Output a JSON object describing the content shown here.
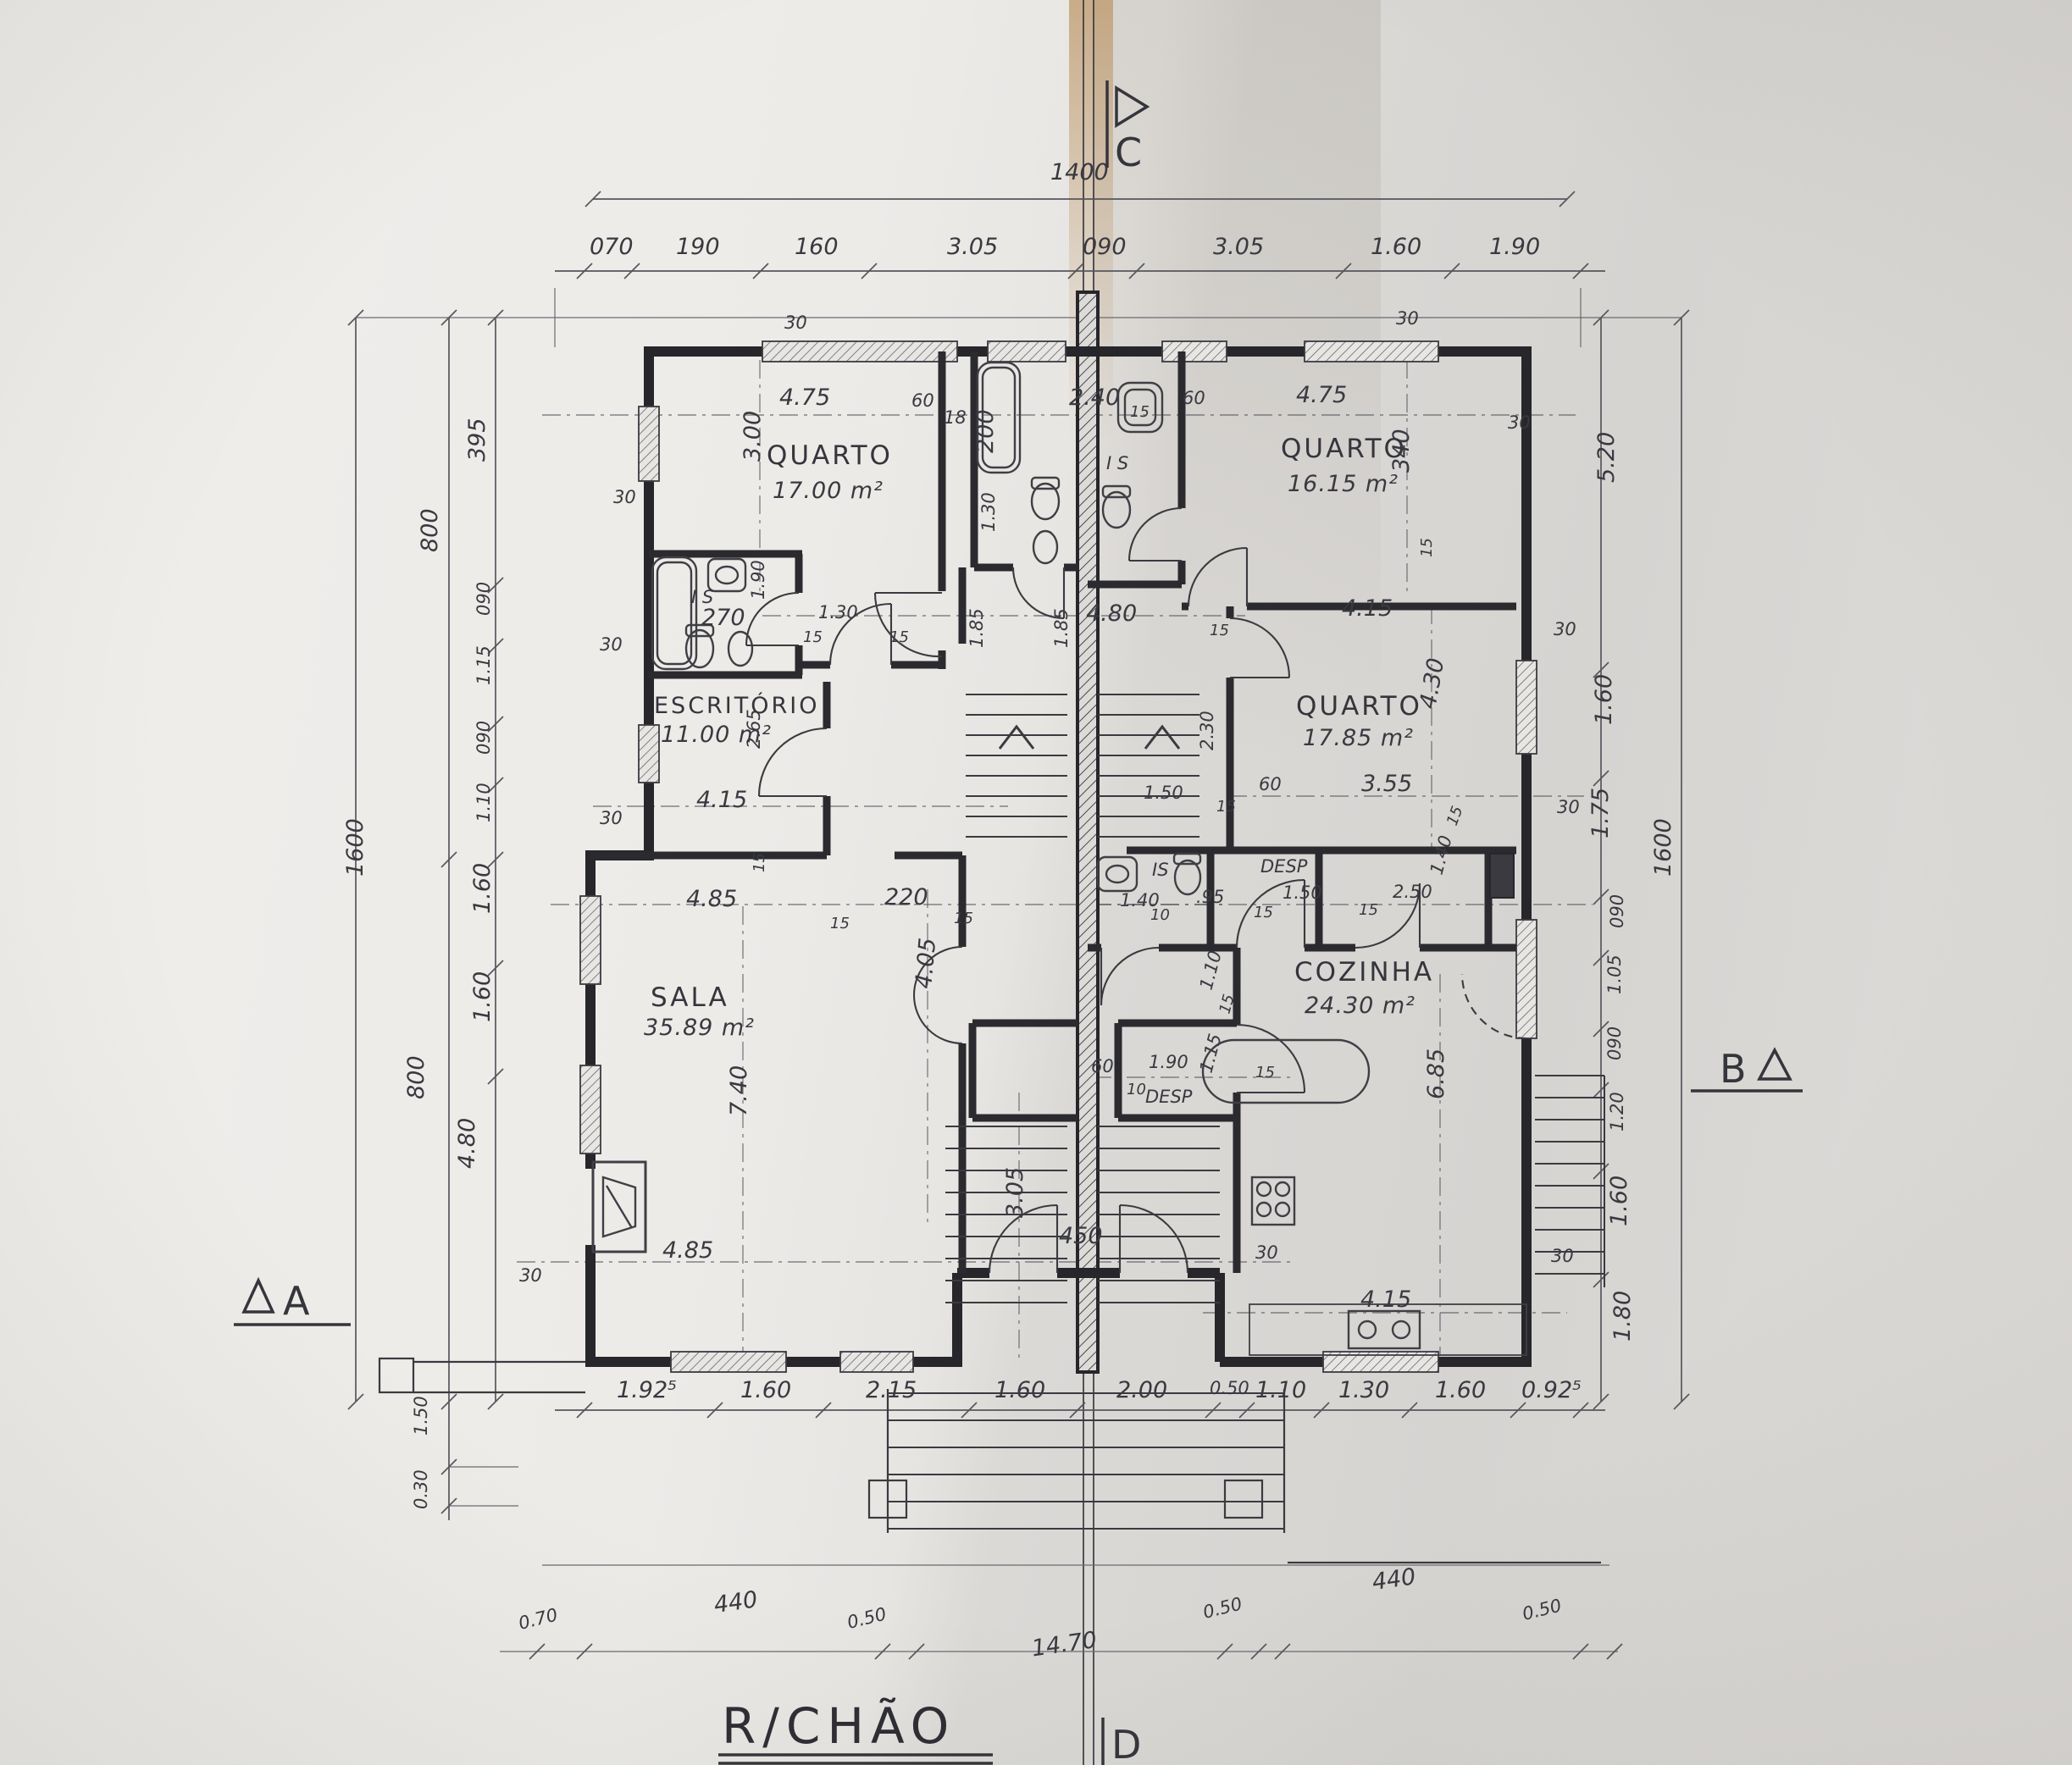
{
  "title": {
    "label": "R/CHÃO"
  },
  "markers": {
    "a": "A",
    "b": "B",
    "c": "C",
    "d": "D"
  },
  "rooms": {
    "quarto1": {
      "name": "QUARTO",
      "area": "17.00 m²"
    },
    "quarto2": {
      "name": "QUARTO",
      "area": "16.15 m²"
    },
    "quarto3": {
      "name": "QUARTO",
      "area": "17.85 m²"
    },
    "escritorio": {
      "name": "ESCRITÓRIO",
      "area": "11.00 m²"
    },
    "sala": {
      "name": "SALA",
      "area": "35.89 m²"
    },
    "cozinha": {
      "name": "COZINHA",
      "area": "24.30 m²"
    },
    "is_left": "I S",
    "is_right": "I S",
    "is_mid": "IS",
    "desp_mid": "DESP",
    "desp_low": "DESP"
  },
  "dims": {
    "overall_top": "1400",
    "overall_bottom": "14.70",
    "top": [
      "070",
      "190",
      "160",
      "3.05",
      "090",
      "3.05",
      "1.60",
      "1.90"
    ],
    "bottom": [
      "1.92⁵",
      "1.60",
      "2.15",
      "1.60",
      "2.00",
      "0.50",
      "1.10",
      "1.30",
      "1.60",
      "0.92⁵"
    ],
    "ground": [
      "0.70",
      "440",
      "0.50",
      "0.50",
      "440",
      "0.50"
    ],
    "left": [
      "1600",
      "800",
      "800",
      "395",
      "090",
      "1.15",
      "090",
      "1.10",
      "1.60",
      "1.60",
      "4.80",
      "1.50",
      "0.30"
    ],
    "right": [
      "5.20",
      "1.60",
      "1.75",
      "1600",
      "090",
      "1.05",
      "090",
      "1.20",
      "1.60",
      "1.80"
    ],
    "interior": [
      "4.75",
      "3.00",
      "30",
      "60",
      "18",
      "2.40",
      "200",
      "1.30",
      "60",
      "4.75",
      "340",
      "30",
      "270",
      "1.90",
      "30",
      "1.30",
      "15",
      "15",
      "15",
      "4.80",
      "1.85",
      "1.85",
      "4.15",
      "2.65",
      "30",
      "4.15",
      "4.30",
      "3.55",
      "2.30",
      "60",
      "1.50",
      "15",
      "30",
      "30",
      "4.85",
      "15",
      "220",
      "15",
      "15",
      "4.05",
      "7.40",
      "1.40",
      "10",
      ".95",
      "1.50",
      "15",
      "15",
      "2.50",
      "1.40",
      "6.85",
      "1.10",
      "15",
      "1.15",
      "15",
      "60",
      "1.90",
      "10",
      "3.05",
      "450",
      "30",
      "30",
      "4.15",
      "4.85",
      "30",
      "30",
      "30",
      "15",
      "15",
      "15"
    ]
  }
}
